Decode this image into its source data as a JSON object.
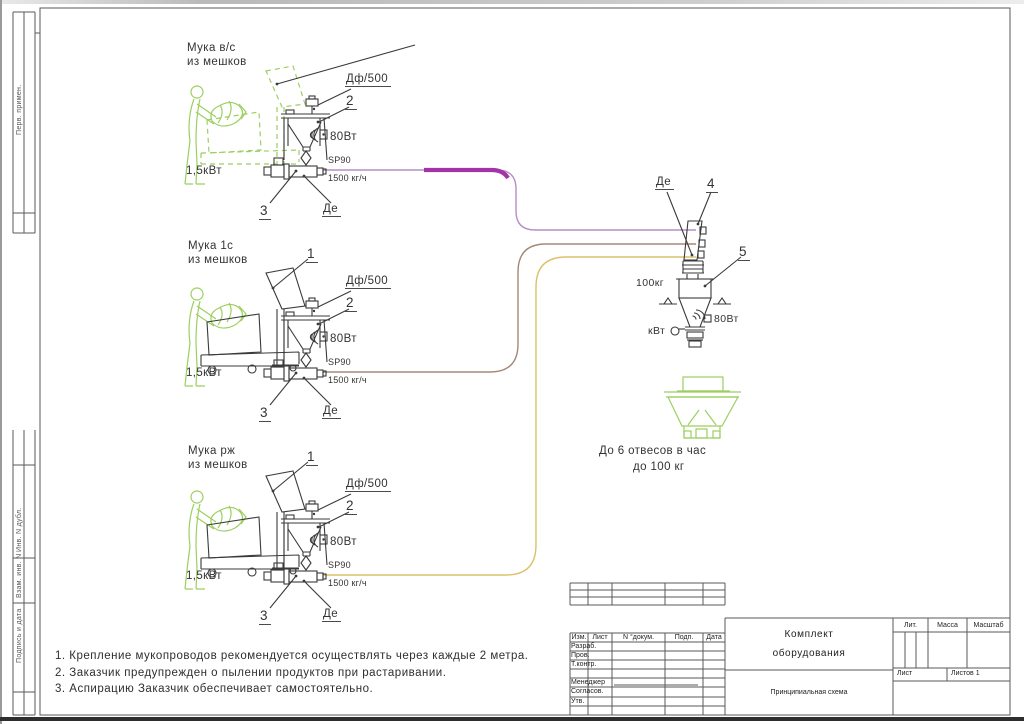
{
  "frame": {
    "left_top_label": "Перв. примен.",
    "left_inv_dubl": "Инв. N дубл.",
    "left_vzam_inv": "Взам. инв. N",
    "left_podpis_data": "Подпись и дата"
  },
  "stations": {
    "common": {
      "num1": "1",
      "num2": "2",
      "num3": "3",
      "filter": "Дф/500",
      "vibro": "80Вт",
      "model": "SP90",
      "capacity": "1500 кг/ч",
      "drive": "1,5кВт",
      "gate": "Де"
    },
    "list": [
      {
        "line1": "Мука в/с",
        "line2": "из мешков"
      },
      {
        "line1": "Мука 1с",
        "line2": "из мешков"
      },
      {
        "line1": "Мука рж",
        "line2": "из мешков"
      }
    ]
  },
  "receiver": {
    "gate": "Де",
    "num4": "4",
    "num5": "5",
    "weight": "100кг",
    "vibro": "80Вт",
    "drive": "кВт",
    "rate_line1": "До 6 отвесов в час",
    "rate_line2": "до 100 кг"
  },
  "notes": [
    "1. Крепление мукопроводов рекомендуется осуществлять через каждые 2 метра.",
    "2. Заказчик предупрежден о пылении продуктов при растаривании.",
    "3. Аспирацию Заказчик обеспечивает самостоятельно."
  ],
  "titleblock": {
    "col_izm": "Изм.",
    "col_list": "Лист",
    "col_ndoc": "N °докум.",
    "col_podp": "Подп.",
    "col_data": "Дата",
    "row_razrab": "Разраб.",
    "row_prov": "Пров.",
    "row_tkontr": "Т.контр.",
    "row_manager": "Менеджер",
    "row_soglasov": "Согласов.",
    "row_utv": "Утв.",
    "doc_title_line1": "Комплект",
    "doc_title_line2": "оборудования",
    "scheme_name": "Принципиальная схема",
    "lit": "Лит.",
    "mass": "Масса",
    "scale": "Масштаб",
    "sheet": "Лист",
    "sheets": "Листов 1"
  },
  "colors": {
    "magenta_bold": "#a233a8",
    "purple_pipe": "#b48fc6",
    "brown_pipe": "#a38878",
    "yellow_pipe": "#dcc16b",
    "green_equipment": "#9ccf5f",
    "ink": "#3a3a3a",
    "frame": "#5a5a5a"
  }
}
